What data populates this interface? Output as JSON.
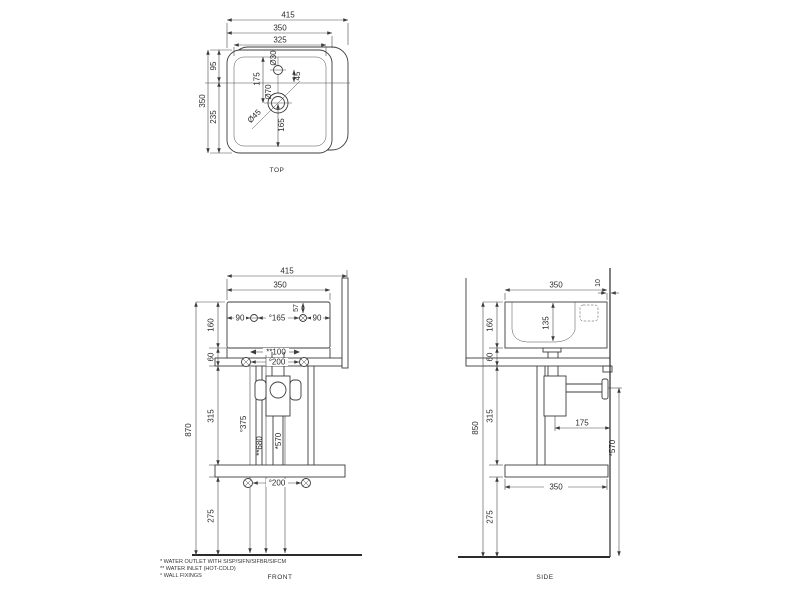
{
  "drawing": {
    "views": {
      "top": {
        "label": "TOP",
        "dims": {
          "overall_width": "415",
          "rim_width": "350",
          "inner_width": "325",
          "depth": "350",
          "top_to_axis": "95",
          "axis_to_bottom": "235",
          "top_to_drain": "175",
          "faucet_to_axis": "45",
          "faucet_hole_dia": "Ø30",
          "drain_outer_dia": "Ø70",
          "drain_dia": "Ø45",
          "drain_to_bottom": "165"
        }
      },
      "front": {
        "label": "FRONT",
        "dims": {
          "overall_width": "415",
          "basin_width": "350",
          "hole_offset_left": "90",
          "hole_spacing": "°165",
          "hole_offset_right": "90",
          "hole_from_top": "57",
          "basin_height": "160",
          "apron_height": "60",
          "mid_height": "315",
          "overall_height": "870",
          "bottom_height": "275",
          "inlet_spacing": "**100",
          "rail_fixing_spacing": "°200",
          "shelf_fixing_spacing": "°200",
          "fixing_height": "°375",
          "inlet_height": "**680",
          "outlet_height": "*570"
        }
      },
      "side": {
        "label": "SIDE",
        "dims": {
          "basin_depth": "350",
          "wall_gap": "10",
          "basin_height": "160",
          "bowl_depth": "135",
          "apron_height": "60",
          "mid_height": "315",
          "overall_height": "850",
          "bottom_height": "275",
          "trap_to_wall": "175",
          "shelf_depth": "350",
          "outlet_height": "*570"
        }
      }
    },
    "footnotes": [
      "*  WATER OUTLET WITH SISP/SIFN/SIFBR/SIFCM",
      "** WATER INLET  (HOT-COLD)",
      "°  WALL FIXINGS"
    ],
    "colors": {
      "line": "#3c3c3c",
      "background": "#ffffff"
    }
  }
}
